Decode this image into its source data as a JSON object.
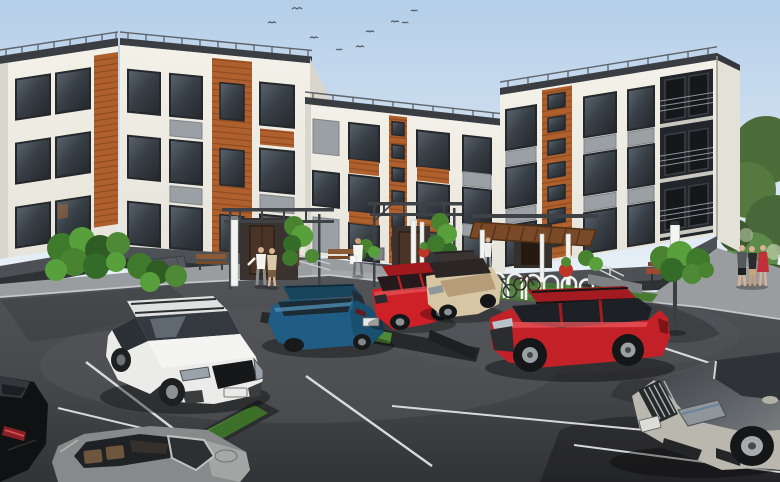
{
  "scene": {
    "type": "3d-architectural-exterior-render",
    "description": "Daytime visualization of a modern 3-storey U-shaped apartment building with white facades, wood-cladding accents, gray spandrel panels, rooftop guardrails, recessed corner balconies, three canopied entrances with benches and bike racks, landscaping, pedestrians and a foreground parking lot with eight cars",
    "sky": {
      "top": "#b5cfe9",
      "mid": "#d3e2f1",
      "horizon": "#edf3f9",
      "bird_count": 9
    }
  },
  "palette": {
    "facade": "#f1eee6",
    "facade_shade": "#d9d6ce",
    "wood": "#b0602d",
    "wood_line": "#8a4a20",
    "gray_panel": "#9aa0a4",
    "parapet": "#3a3d42",
    "glass": "#3b4147",
    "asphalt": "#47494d",
    "sidewalk": "#9a9da0",
    "grass": "#4e8a36",
    "tree_green": "#4c7038",
    "line_white": "#e9ebeb",
    "planter_red": "#c13528"
  },
  "building": {
    "floors": 3,
    "wings": 3,
    "features": [
      "rooftop guardrails",
      "wood cladding accent panels",
      "gray spandrel panels",
      "stairwell window columns",
      "recessed balconies on right corner",
      "dark plinth with ventilation grate"
    ],
    "entrances": [
      {
        "name": "left-entrance",
        "canopy": "dark steel pergola",
        "door": "dark timber door",
        "lamp": "white light bollard",
        "bench": true
      },
      {
        "name": "center-entrance",
        "canopy": "dark steel pergola",
        "door": "dark timber door",
        "lamp": "white light posts",
        "bench": true,
        "planter": "red round planter"
      },
      {
        "name": "right-entrance",
        "canopy": "timber-slat canopy on white posts",
        "bike_rack_hoops": 7,
        "bicycles": 2,
        "planter": "red round planter"
      }
    ]
  },
  "people": [
    {
      "name": "couple-at-left-entrance",
      "detail": "man in white tee with gray trousers and companion in beige top, walking to door"
    },
    {
      "name": "person-with-bag",
      "detail": "figure in white carrying a white bag on the courtyard walk"
    },
    {
      "name": "person-at-right-walk",
      "detail": "figure in white near right entrance walkway"
    },
    {
      "name": "group-right",
      "detail": "three pedestrians at right corner, one woman in a red dress"
    }
  ],
  "cars": [
    {
      "name": "blue-crossover",
      "color": "#1f5d84",
      "position": "middle row, rear three-quarter view"
    },
    {
      "name": "red-hatchback",
      "color": "#cd2127",
      "position": "middle row behind blue crossover"
    },
    {
      "name": "beige-wagon",
      "color": "#d7c6a4",
      "position": "middle row, dark roof with rails"
    },
    {
      "name": "red-suv",
      "color": "#c22127",
      "position": "center right, side view, nose left"
    },
    {
      "name": "white-suv",
      "color": "#ebecea",
      "position": "center left, front three-quarter, black grille, license plate illegible"
    },
    {
      "name": "black-car",
      "color": "#101113",
      "position": "bottom-left corner, rear quarter with lit tail lamp"
    },
    {
      "name": "pewter-convertible",
      "color": "#87898a",
      "position": "bottom center, seen from above with open cockpit"
    },
    {
      "name": "silver-sedan",
      "color": "#bab7ae",
      "position": "bottom right, vertical-slat grille, hood reflecting trees"
    }
  ],
  "parking": {
    "stall_line_color": "#e9ebeb",
    "grass_medians": 2,
    "street_lamps": 1,
    "tree_shadows": true
  }
}
